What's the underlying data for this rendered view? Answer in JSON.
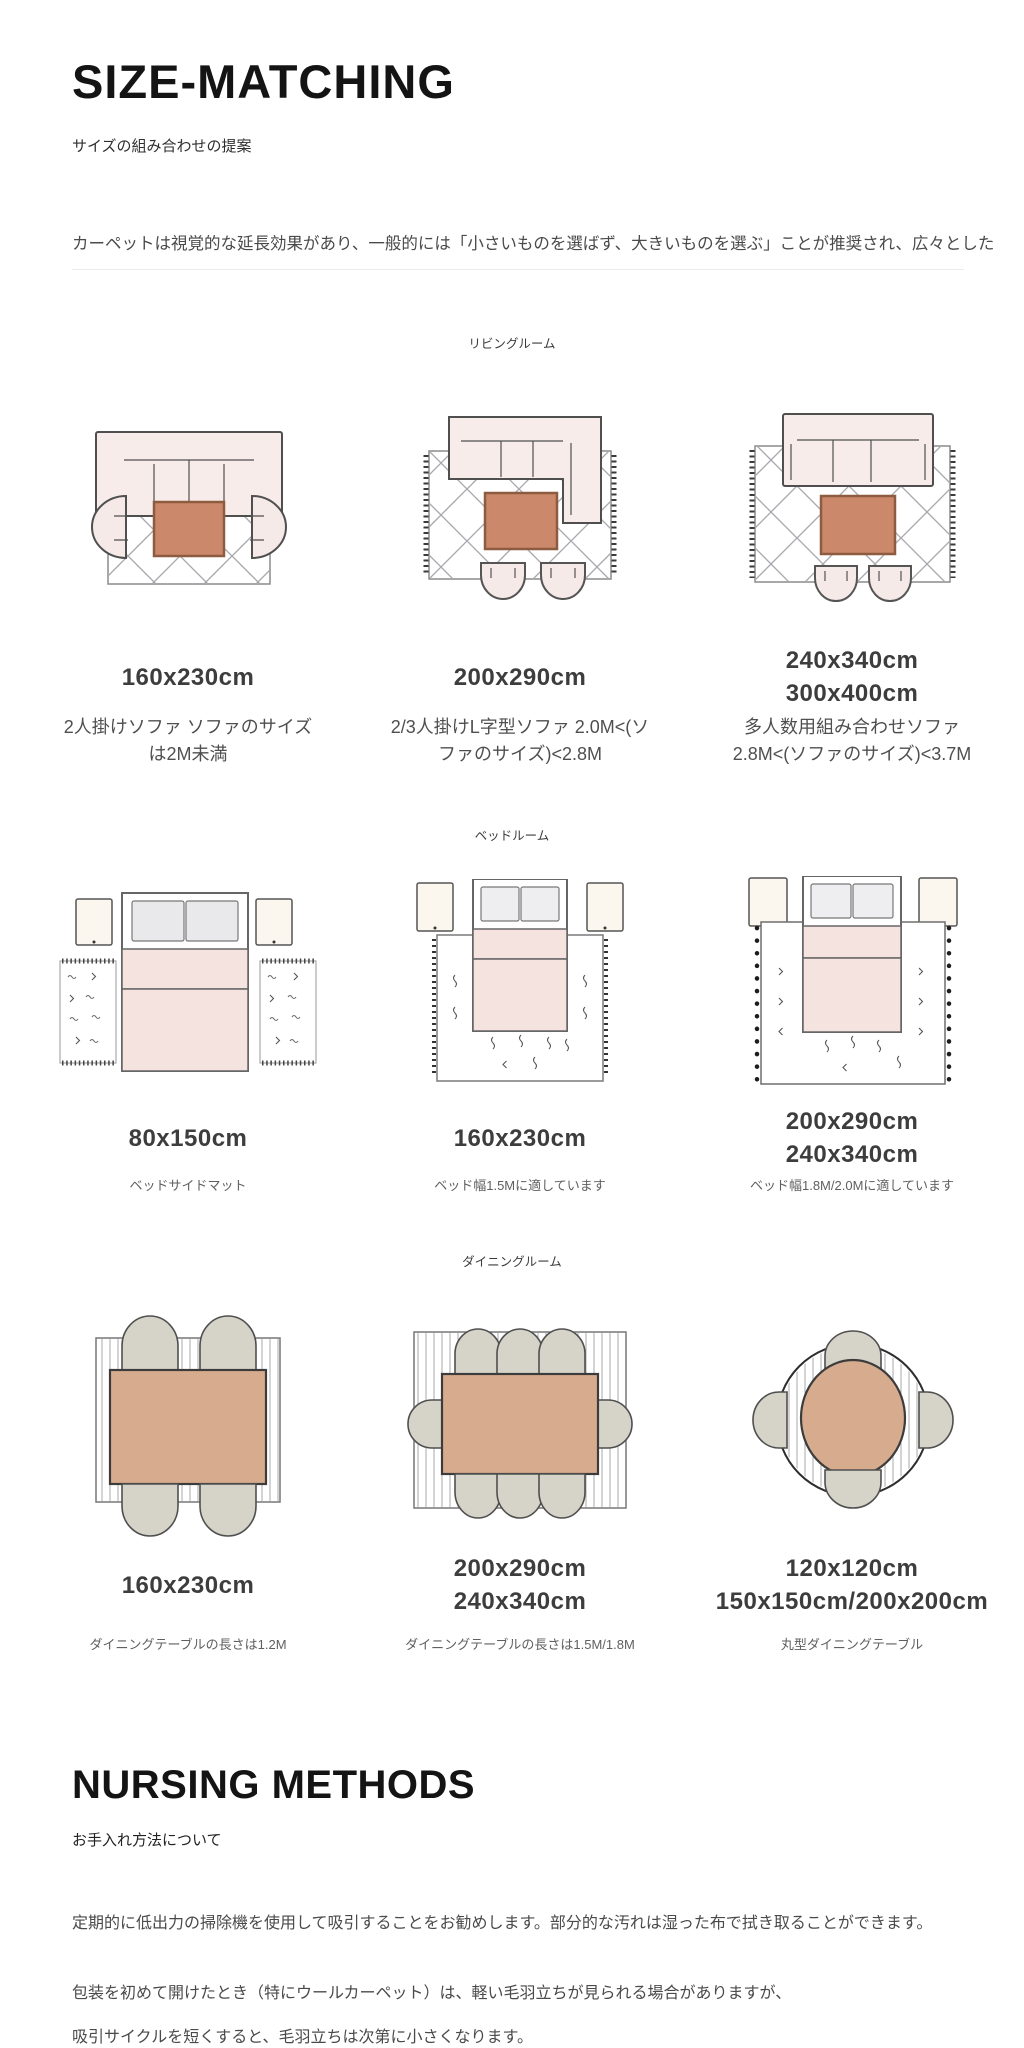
{
  "header": {
    "title": "SIZE-MATCHING",
    "subtitle": "サイズの組み合わせの提案",
    "intro": "カーペットは視覚的な延長効果があり、一般的には「小さいものを選ばず、大きいものを選ぶ」ことが推奨され、広々とした"
  },
  "rooms": [
    {
      "label": "リビングルーム",
      "items": [
        {
          "sizes": [
            "160x230cm"
          ],
          "desc": "2人掛けソファ ソファのサイズは2M未満"
        },
        {
          "sizes": [
            "200x290cm"
          ],
          "desc": "2/3人掛けL字型ソファ 2.0M<(ソファのサイズ)<2.8M"
        },
        {
          "sizes": [
            "240x340cm",
            "300x400cm"
          ],
          "desc": "多人数用組み合わせソファ 2.8M<(ソファのサイズ)<3.7M"
        }
      ]
    },
    {
      "label": "ベッドルーム",
      "items": [
        {
          "sizes": [
            "80x150cm"
          ],
          "desc": "ベッドサイドマット"
        },
        {
          "sizes": [
            "160x230cm"
          ],
          "desc": "ベッド幅1.5Mに適しています"
        },
        {
          "sizes": [
            "200x290cm",
            "240x340cm"
          ],
          "desc": "ベッド幅1.8M/2.0Mに適しています"
        }
      ]
    },
    {
      "label": "ダイニングルーム",
      "items": [
        {
          "sizes": [
            "160x230cm"
          ],
          "desc": "ダイニングテーブルの長さは1.2M"
        },
        {
          "sizes": [
            "200x290cm",
            "240x340cm"
          ],
          "desc": "ダイニングテーブルの長さは1.5M/1.8M"
        },
        {
          "sizes": [
            "120x120cm",
            "150x150cm/200x200cm"
          ],
          "desc": "丸型ダイニングテーブル"
        }
      ]
    }
  ],
  "care": {
    "title": "NURSING METHODS",
    "subtitle": "お手入れ方法について",
    "paragraphs": [
      "定期的に低出力の掃除機を使用して吸引することをお勧めします。部分的な汚れは湿った布で拭き取ることができます。",
      "包装を初めて開けたとき（特にウールカーペット）は、軽い毛羽立ちが見られる場合がありますが、",
      "吸引サイクルを短くすると、毛羽立ちは次第に小さくなります。"
    ]
  },
  "colors": {
    "coffee_table": "#cb886a",
    "dining_table": "#d7ab8d",
    "sofa_pink": "#f8ecea",
    "blanket_pink": "#f4e3df",
    "chair_gray": "#d6d4c8",
    "nightstand_cream": "#fcf7ee",
    "heading_text": "#141414",
    "size_text": "#3d3d3d",
    "body_text": "#4a4a4a",
    "lattice_line": "#a8a8ae"
  }
}
